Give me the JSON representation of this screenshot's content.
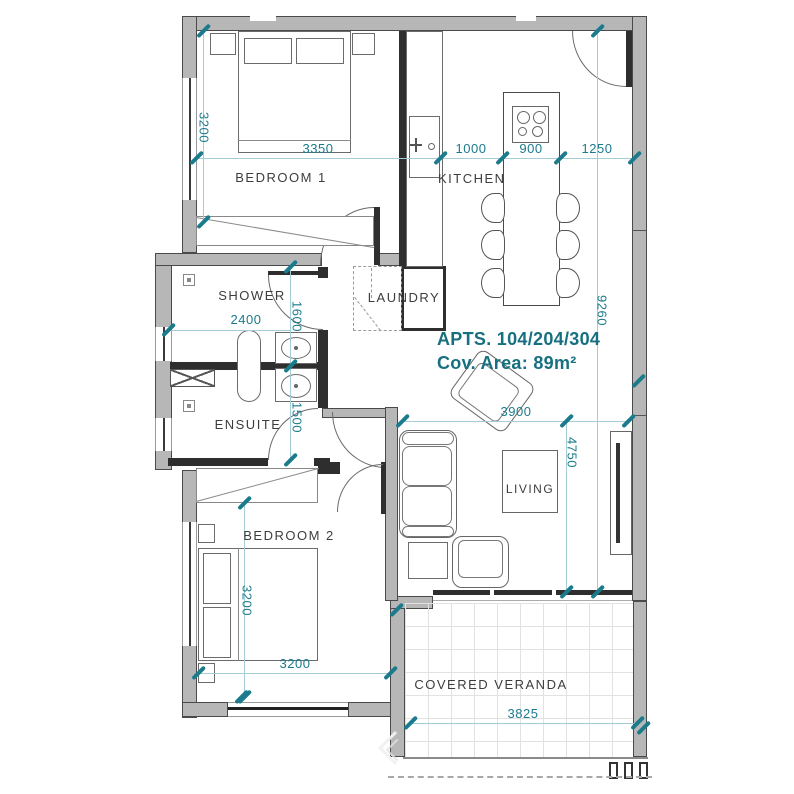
{
  "title": {
    "line1": "APTS. 104/204/304",
    "line2": "Cov. Area: 89m²"
  },
  "rooms": {
    "bedroom1": "BEDROOM 1",
    "kitchen": "KITCHEN",
    "shower": "SHOWER",
    "laundry": "LAUNDRY",
    "ensuite": "ENSUITE",
    "bedroom2": "BEDROOM 2",
    "living": "LIVING",
    "veranda": "COVERED VERANDA"
  },
  "dims": {
    "bedroom1_width": "3350",
    "kitchen_left": "1000",
    "island_width": "900",
    "kitchen_right": "1250",
    "bedroom1_depth": "3200",
    "overall_depth": "9260",
    "shower_width": "2400",
    "shower_depth": "1600",
    "ensuite_depth": "1500",
    "living_width": "3900",
    "living_depth": "4750",
    "bedroom2_depth": "3200",
    "bedroom2_width": "3200",
    "veranda_width": "3825"
  },
  "colors": {
    "dim_text": "#1b7b8d",
    "dim_line": "#a5cdd5",
    "wall": "#b7b7b7",
    "wall_dark": "#2e2e2e",
    "room_label": "#3d3d3d",
    "title": "#17707f"
  }
}
